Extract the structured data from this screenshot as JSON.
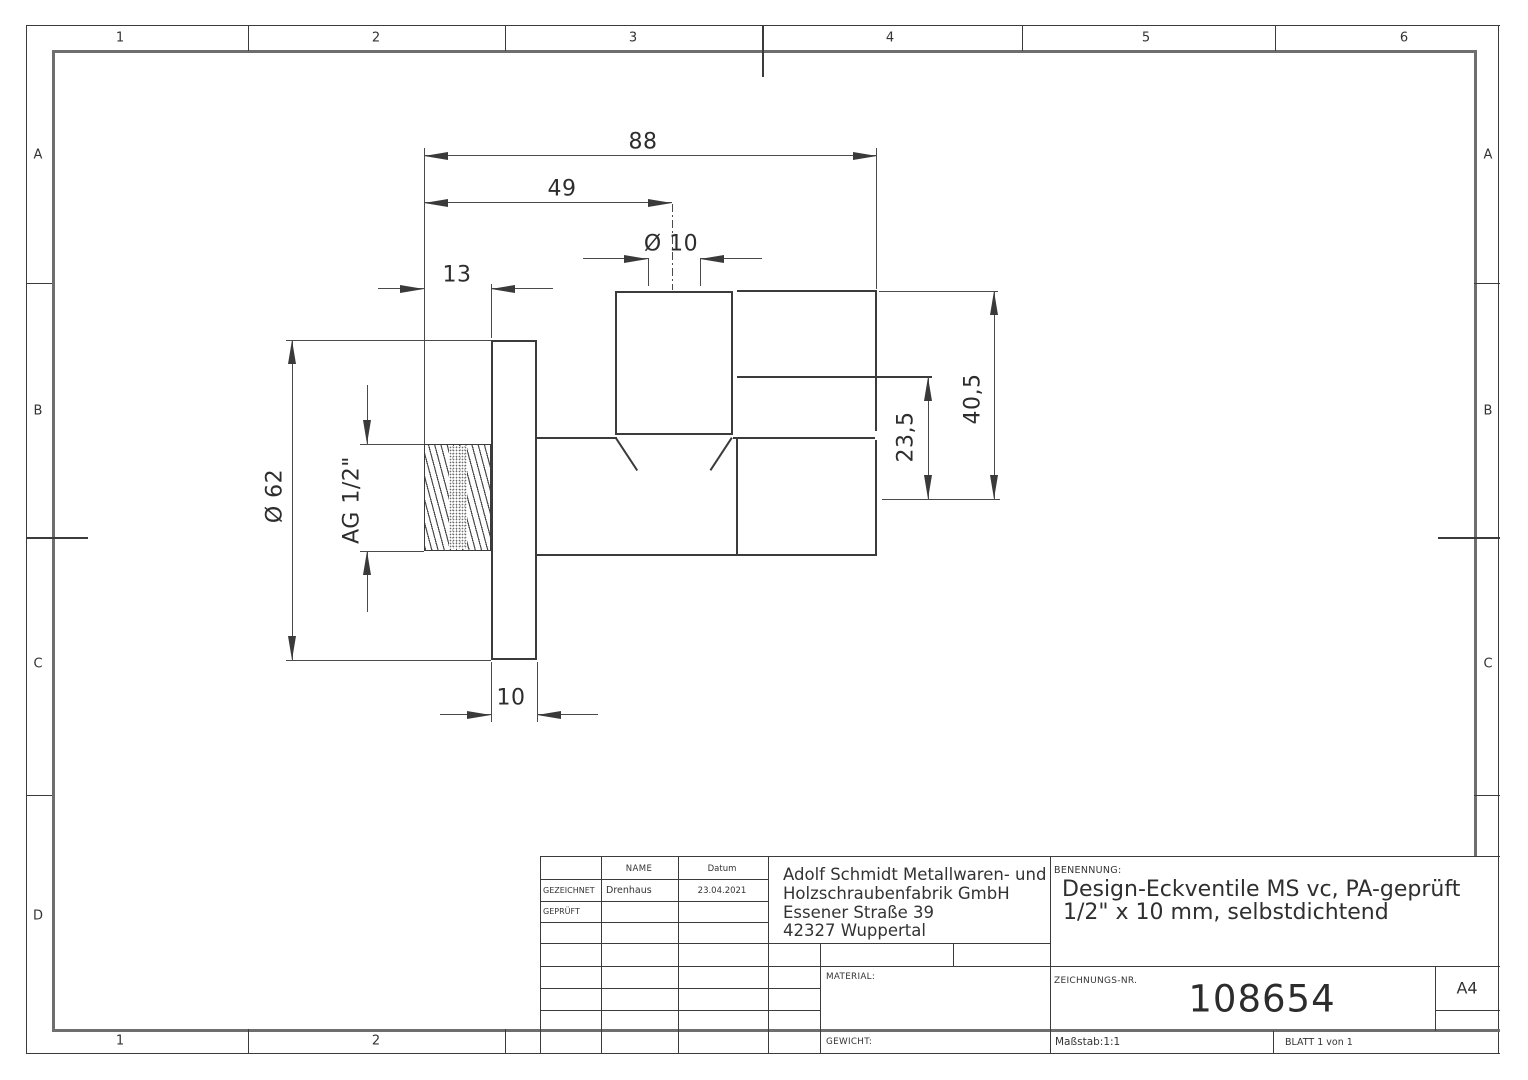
{
  "frame": {
    "columns_top": [
      "1",
      "2",
      "3",
      "4",
      "5",
      "6"
    ],
    "columns_bottom": [
      "1",
      "2"
    ],
    "rows_left": [
      "A",
      "B",
      "C",
      "D"
    ],
    "rows_right": [
      "A",
      "B",
      "C"
    ]
  },
  "dimensions": {
    "total_width": "88",
    "width_to_axis": "49",
    "outlet_diameter": "Ø 10",
    "thread_length": "13",
    "plate_diameter": "Ø 62",
    "thread_size": "AG 1/2\"",
    "height_body": "23,5",
    "height_total": "40,5",
    "plate_thickness": "10"
  },
  "title_block": {
    "name_header": "NAME",
    "date_header": "Datum",
    "drawn_label": "GEZEICHNET",
    "drawn_by": "Drenhaus",
    "drawn_date": "23.04.2021",
    "checked_label": "GEPRÜFT",
    "company_lines": [
      "Adolf Schmidt Metallwaren- und",
      "Holzschraubenfabrik GmbH",
      "Essener Straße 39",
      "42327 Wuppertal"
    ],
    "benennung_label": "BENENNUNG:",
    "title_line1": "Design-Eckventile MS vc, PA-geprüft",
    "title_line2": "1/2\" x 10 mm, selbstdichtend",
    "material_label": "MATERIAL:",
    "weight_label": "GEWICHT:",
    "drawing_no_label": "ZEICHNUNGS-NR.",
    "drawing_no": "108654",
    "paper_format": "A4",
    "scale": "Maßstab:1:1",
    "sheet": "BLATT 1 von 1"
  }
}
